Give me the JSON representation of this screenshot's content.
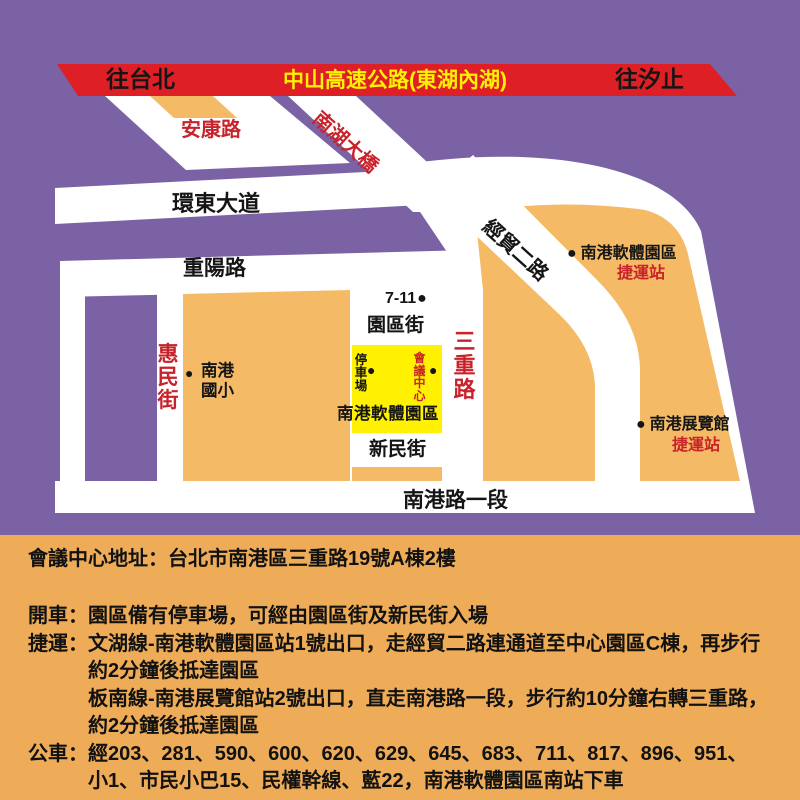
{
  "map": {
    "dot": "●",
    "banner": {
      "to_taipei": "往台北",
      "highway": "中山高速公路(東湖內湖)",
      "to_xizhi": "往汐止"
    },
    "roads": {
      "ankang": "安康路",
      "nanhu_bridge": "南湖大橋",
      "huandong_blvd": "環東大道",
      "chongyang_rd": "重陽路",
      "jingmao_2nd_rd": "經貿二路",
      "sanchong_rd": "三重路",
      "huimin_st": "惠民街",
      "yuanqu_st": "園區街",
      "xinmin_st": "新民街",
      "nangang_rd_sec1": "南港路一段"
    },
    "pois": {
      "seven_eleven": "7-11",
      "software_park_station": {
        "name": "南港軟體園區",
        "sub": "捷運站"
      },
      "exhibition_station": {
        "name": "南港展覽館",
        "sub": "捷運站"
      },
      "elementary_school_line1": "南港",
      "elementary_school_line2": "國小",
      "parking": "停車場",
      "conference_center": "會議中心",
      "software_park_label": "南港軟體園區"
    },
    "colors": {
      "background_purple": "#7a62a5",
      "road_white": "#ffffff",
      "block_orange": "#f5ba66",
      "highway_red": "#de2026",
      "highlight_yellow": "#fff100",
      "label_red": "#c8222a"
    }
  },
  "info": {
    "address": "會議中心地址：台北市南港區三重路19號A棟2樓",
    "drive": {
      "label": "開車：",
      "text": "園區備有停車場，可經由園區街及新民街入場"
    },
    "mrt": {
      "label": "捷運：",
      "line1": "文湖線-南港軟體園區站1號出口，走經貿二路連通道至中心園區C棟，再步行",
      "line2": "約2分鐘後抵達園區",
      "line3": "板南線-南港展覽館站2號出口，直走南港路一段，步行約10分鐘右轉三重路，",
      "line4": "約2分鐘後抵達園區"
    },
    "bus": {
      "label": "公車：",
      "line1": "經203、281、590、600、620、629、645、683、711、817、896、951、",
      "line2": "小1、市民小巴15、民權幹線、藍22，南港軟體園區南站下車"
    }
  }
}
